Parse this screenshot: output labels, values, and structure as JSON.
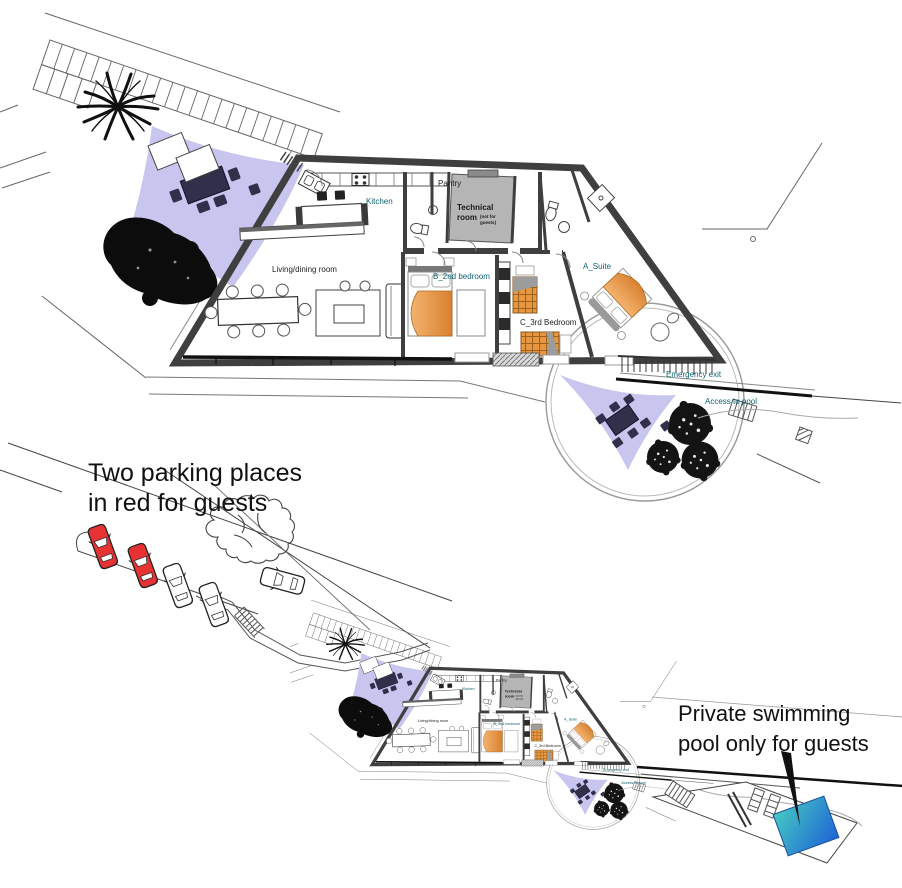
{
  "drawing": {
    "annotations": {
      "parking_note_line1": "Two parking places",
      "parking_note_line2": "in red for guests",
      "pool_note_line1": "Private swimming",
      "pool_note_line2": "pool only for guests"
    },
    "rooms": {
      "kitchen": "Kitchen",
      "pantry": "Pantry",
      "technical_line1": "Technical",
      "technical_line2": "room",
      "technical_note_line1": "(not for",
      "technical_note_line2": "guests)",
      "living": "Living/dining room",
      "bedroom_b": "B_2nd bedroom",
      "bedroom_c": "C_3rd Bedroom",
      "suite": "A_Suite"
    },
    "site_labels": {
      "emergency_exit": "Emergency exit",
      "access_to_pool": "Access to pool"
    },
    "colors": {
      "shade_sail": "#c8c5ee",
      "sail_furniture": "#30304a",
      "bed_light": "#f4b36e",
      "bed_dark": "#d8812f",
      "bed_plaid": "#e8973f",
      "technical_room_fill": "#b5b5b5",
      "label_teal": "#0f6272",
      "guest_car_red": "#e63232",
      "pool_light": "#45c8c2",
      "pool_dark": "#1f63d6"
    }
  }
}
